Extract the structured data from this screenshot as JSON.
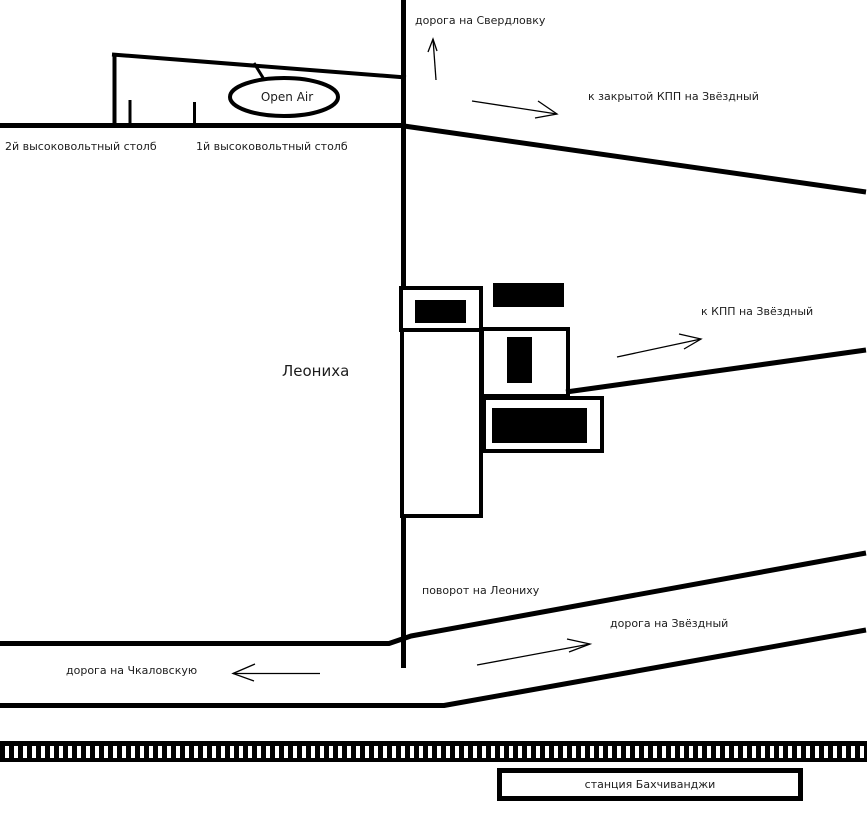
{
  "colors": {
    "ink": "#000000",
    "text": "#1c1c1c",
    "background": "#ffffff"
  },
  "labels": {
    "road_sverdlovka": "дорога на Свердловку",
    "closed_kpp": "к закрытой КПП на Звёздный",
    "pole_2": "2й высоковольтный столб",
    "pole_1": "1й высоковольтный столб",
    "open_air": "Open Air",
    "village": "Леониха",
    "kpp": "к КПП на Звёздный",
    "turn_leonikha": "поворот на Леониху",
    "road_zvyozdny": "дорога на Звёздный",
    "road_chkalovskaya": "дорога на Чкаловскую",
    "station": "станция Бахчиванджи"
  },
  "icons": {
    "arrow_up_icon": "↑",
    "arrow_down_right_icon": "↘",
    "arrow_up_right_icon": "↗",
    "arrow_left_icon": "←"
  }
}
